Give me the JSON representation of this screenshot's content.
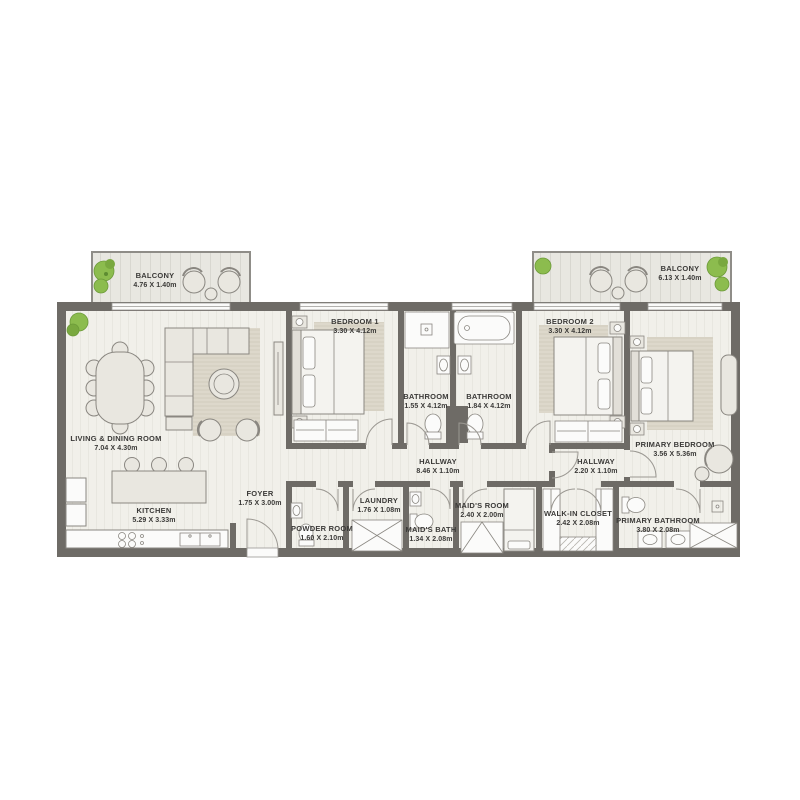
{
  "plan": {
    "type": "apartment-floor-plan",
    "colors": {
      "wall": "#6e6b66",
      "floor": "#f1f0ea",
      "balcony_floor": "#e8e7e1",
      "furniture_fill": "#e9e7e0",
      "white_fixture": "#fbfbfa",
      "rug": "#ddd8cb",
      "plant_green": "#8cbc4e",
      "label_text": "#3b3a38"
    },
    "rooms": {
      "balcony_left": {
        "name": "BALCONY",
        "dims": "4.76 X 1.40m"
      },
      "balcony_right": {
        "name": "BALCONY",
        "dims": "6.13 X 1.40m"
      },
      "living_dining": {
        "name": "LIVING & DINING ROOM",
        "dims": "7.04 X 4.30m"
      },
      "kitchen": {
        "name": "KITCHEN",
        "dims": "5.29 X 3.33m"
      },
      "foyer": {
        "name": "FOYER",
        "dims": "1.75 X 3.00m"
      },
      "bedroom1": {
        "name": "BEDROOM 1",
        "dims": "3.30 X 4.12m"
      },
      "bathroom1": {
        "name": "BATHROOM",
        "dims": "1.55 X 4.12m"
      },
      "bathroom2": {
        "name": "BATHROOM",
        "dims": "1.84 X 4.12m"
      },
      "bedroom2": {
        "name": "BEDROOM 2",
        "dims": "3.30 X 4.12m"
      },
      "primary_bedroom": {
        "name": "PRIMARY BEDROOM",
        "dims": "3.56 X 5.36m"
      },
      "hallway_main": {
        "name": "HALLWAY",
        "dims": "8.46 X 1.10m"
      },
      "hallway_primary": {
        "name": "HALLWAY",
        "dims": "2.20 X 1.10m"
      },
      "powder_room": {
        "name": "POWDER ROOM",
        "dims": "1.60 X 2.10m"
      },
      "laundry": {
        "name": "LAUNDRY",
        "dims": "1.76 X 1.08m"
      },
      "maids_bath": {
        "name": "MAID'S BATH",
        "dims": "1.34 X 2.08m"
      },
      "maids_room": {
        "name": "MAID'S ROOM",
        "dims": "2.40 X 2.00m"
      },
      "walk_in_closet": {
        "name": "WALK-IN CLOSET",
        "dims": "2.42 X 2.08m"
      },
      "primary_bathroom": {
        "name": "PRIMARY BATHROOM",
        "dims": "3.80 X 2.08m"
      }
    }
  }
}
